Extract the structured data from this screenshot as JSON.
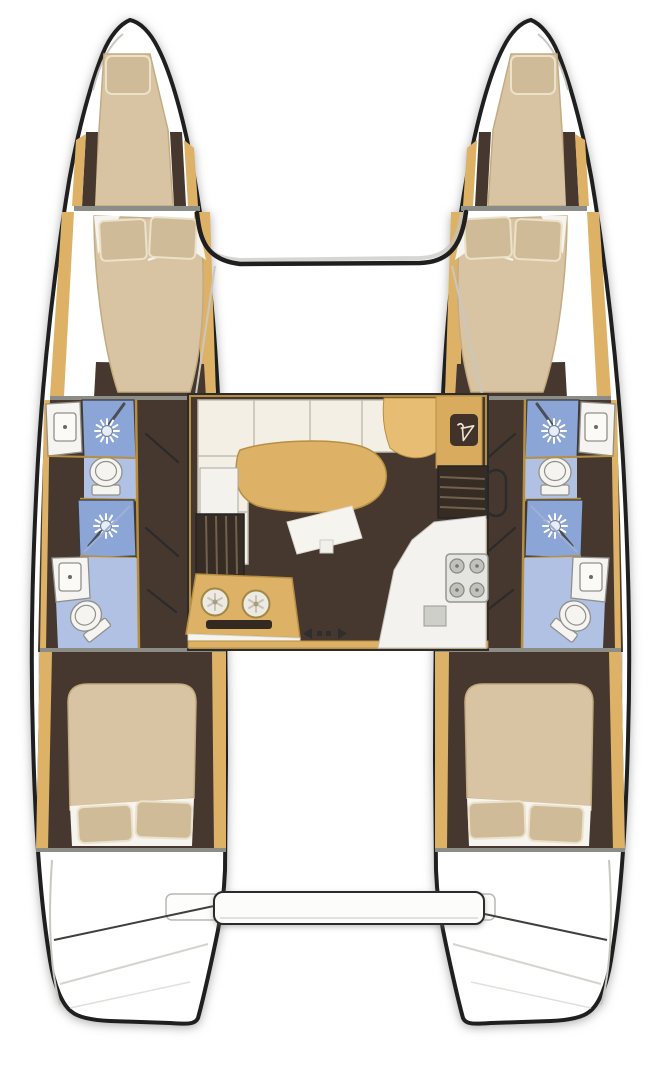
{
  "meta": {
    "title": "Catamaran 4-cabin / 4-head interior floor plan, top-down view with bow up",
    "view": "top-down-bow-up"
  },
  "colors": {
    "outline": "#1f1f1f",
    "wood": "#ddb267",
    "wood-line": "#b68f42",
    "wood-light": "#e6bd72",
    "wood-deep": "#d8ab5e",
    "mattress": "#d8c4a2",
    "mattress-line": "#c3ab82",
    "pillow": "#cfbb97",
    "pillow-line": "#ece1ca",
    "sheet": "#f6f4ee",
    "floor": "#46382e",
    "step": "#372c24",
    "tread": "#71604d",
    "tile": "#8ba5d6",
    "tile-light": "#b1c1e4",
    "fixture": "#f5f4f0",
    "fixture-line": "#90908b",
    "cream": "#f3efe5",
    "cream-line": "#c2bdae",
    "steel": "#e4e4e0",
    "steel-dark": "#8f8f8a",
    "deck-line": "#c9c7c2",
    "divider": "#8d8d88",
    "hanger-plate": "#41332a",
    "hanger-glyph": "#efe7d2",
    "canvas": "#ffffff"
  },
  "layout": {
    "hulls": [
      {
        "id": "port",
        "compartments": [
          "forepeak-berth",
          "forward-double-cabin",
          "forward-head",
          "aft-head",
          "aft-double-cabin",
          "stern-steps"
        ]
      },
      {
        "id": "starboard",
        "compartments": [
          "forepeak-berth",
          "forward-double-cabin",
          "forward-head",
          "aft-head",
          "aft-double-cabin",
          "stern-steps"
        ]
      }
    ],
    "bridgedeck": [
      "trampoline",
      "forward-crossbeam",
      "saloon",
      "galley",
      "chart-desk",
      "hanging-locker",
      "companionway-steps-port",
      "companionway-steps-starboard",
      "cockpit",
      "aft-platform"
    ],
    "fixtures_per_head": [
      "washbasin",
      "shower",
      "toilet"
    ],
    "saloon_items": [
      "l-shaped-sofa",
      "coffee-table",
      "ottoman",
      "chart-desk",
      "hanging-locker",
      "galley-island-double-sink",
      "oven-slot",
      "stove-4-burner",
      "counter-sink",
      "sliding-door-arrows"
    ]
  },
  "icons": [
    "shower-head-icon",
    "toilet-icon",
    "washbasin-icon",
    "sink-icon",
    "burner-icon",
    "hanger-icon",
    "stairs-icon",
    "door-swing-icon",
    "arrow-left-icon",
    "arrow-right-icon"
  ]
}
